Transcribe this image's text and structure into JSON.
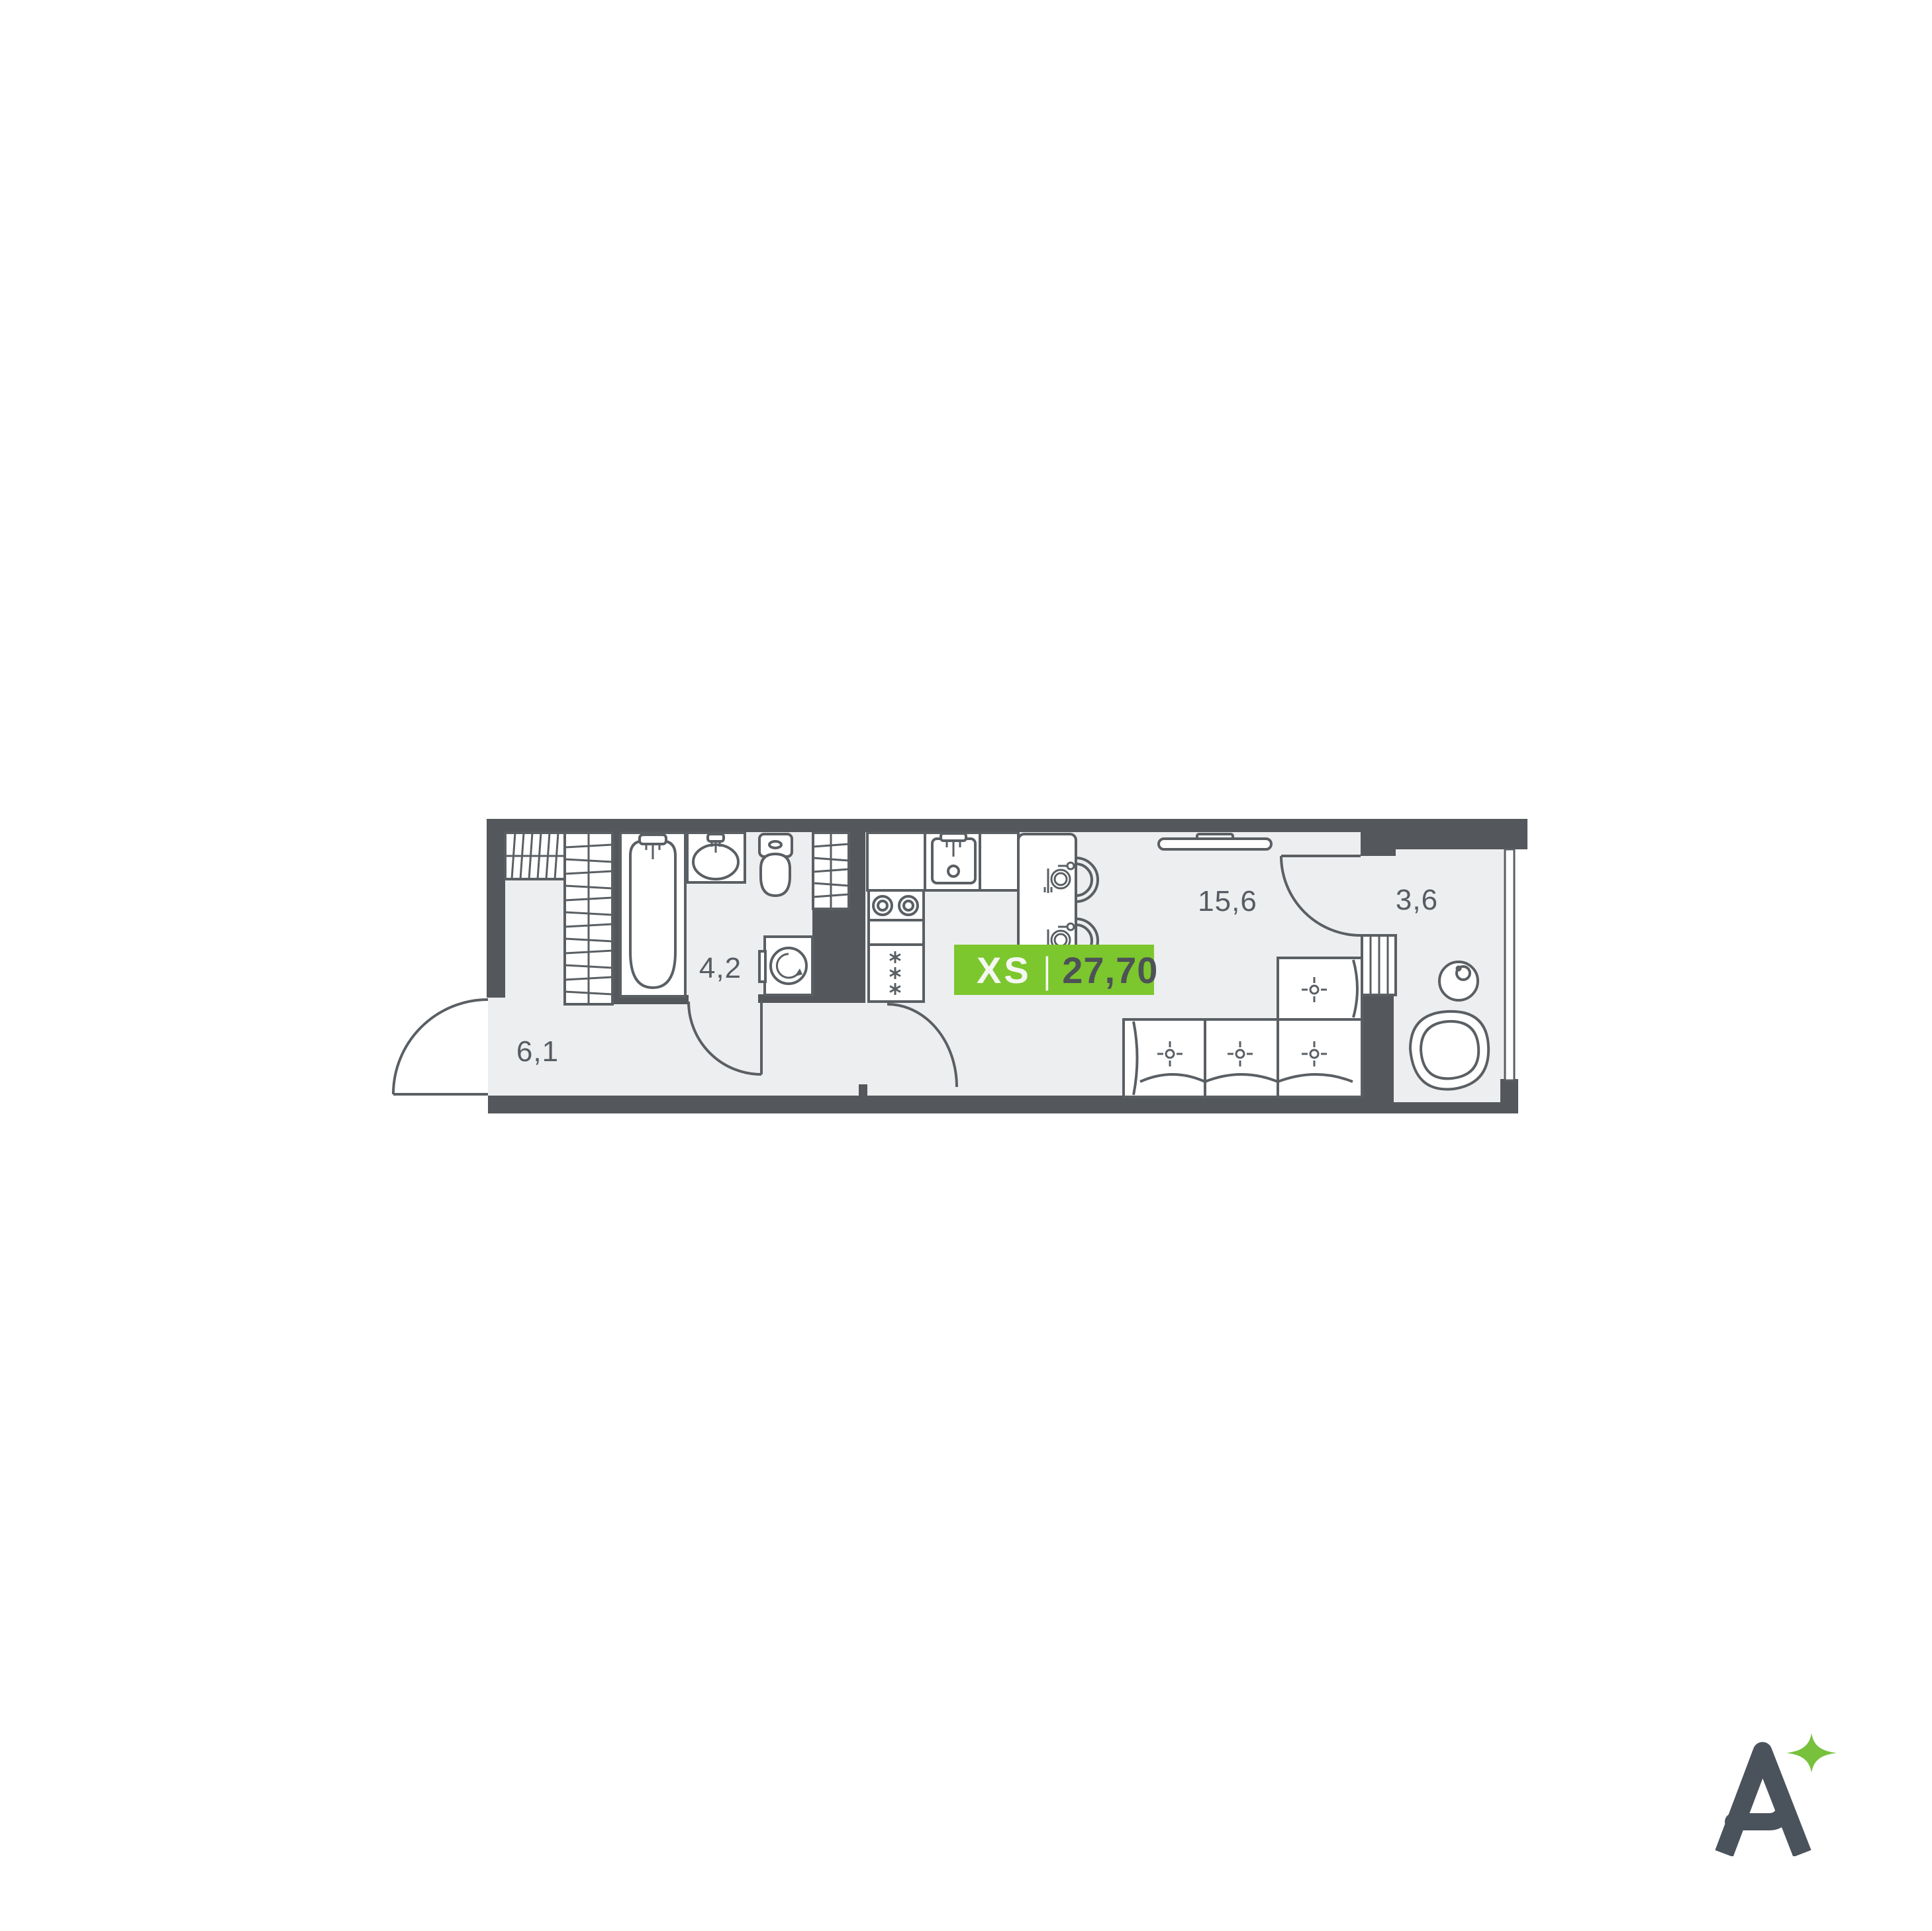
{
  "plan": {
    "badge": {
      "size_label": "XS",
      "separator": "|",
      "area_value": "27,70"
    },
    "rooms": [
      {
        "id": "hallway",
        "area_label": "6,1"
      },
      {
        "id": "bathroom",
        "area_label": "4,2"
      },
      {
        "id": "living-kitchen",
        "area_label": "15,6"
      },
      {
        "id": "balcony",
        "area_label": "3,6"
      }
    ],
    "fixtures": [
      "wardrobe",
      "bathtub",
      "bathroom-sink",
      "toilet",
      "washing-machine",
      "kitchen-counter",
      "kitchen-sink",
      "stove",
      "fridge",
      "dining-table",
      "chair",
      "window-radiator",
      "sofa",
      "balcony-table",
      "balcony-armchair"
    ]
  },
  "logo": {
    "letter": "A"
  },
  "colors": {
    "wall": "#54575B",
    "line": "#5A5F64",
    "floor": "#EDEEEF",
    "background": "#FFFFFF",
    "label": "#565C63",
    "badge_bg": "#7CC72E",
    "badge_label": "#F5F7F3",
    "badge_value": "#4D5257",
    "logo_letter": "#4A525B",
    "logo_star": "#77C13C"
  }
}
